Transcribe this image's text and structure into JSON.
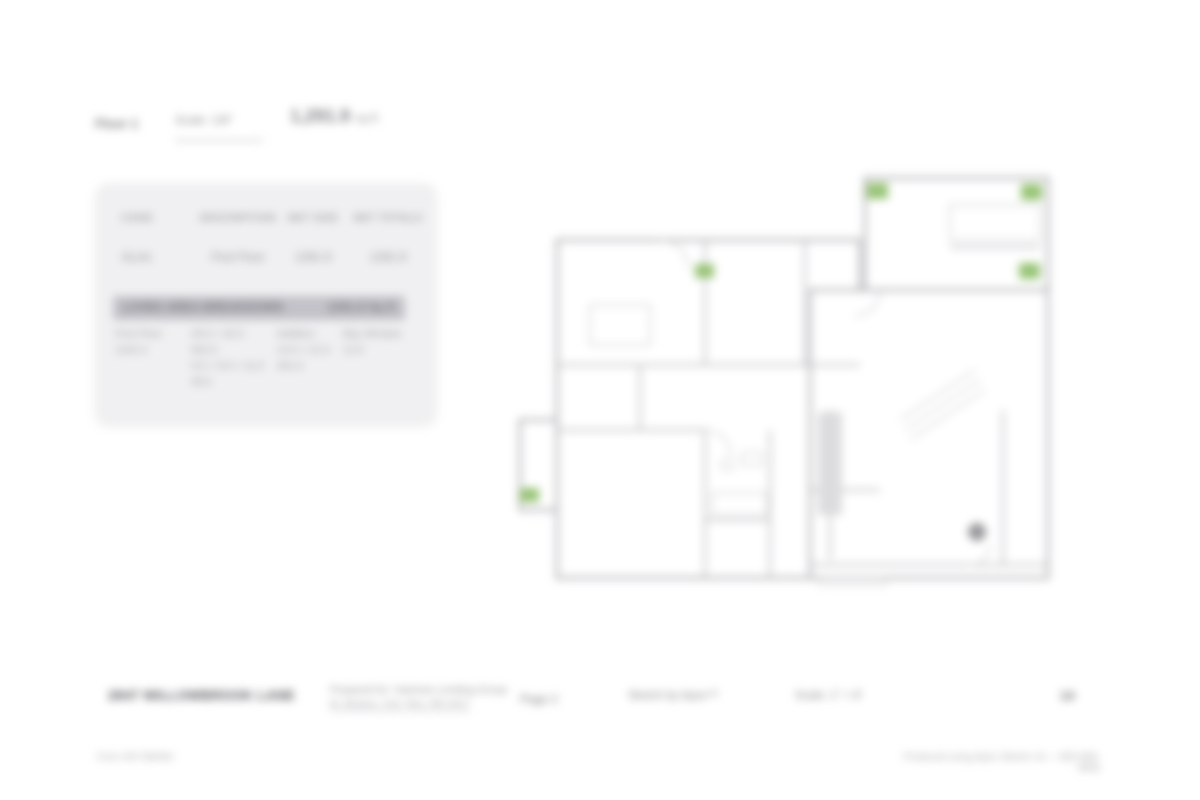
{
  "header": {
    "field1": "Floor 1",
    "field2": "Scale: 1/8\"",
    "area_value": "1,291.9",
    "area_unit": "sq ft"
  },
  "table": {
    "columns": [
      "CODE",
      "DESCRIPTION",
      "NET SIZE",
      "NET TOTALS"
    ],
    "row": [
      "GLA1",
      "First Floor",
      "1291.9",
      "1291.9"
    ],
    "band_left": "LIVING AREA BREAKDOWN",
    "band_right": "1291.9 Sq ft",
    "breakdown_cols": [
      {
        "lines": [
          "First Floor",
          "1242.4"
        ]
      },
      {
        "lines": [
          "29.0 × 32.5",
          "942.5",
          "0.5 × 9.0 × 11.0",
          "49.5"
        ]
      },
      {
        "lines": [
          "Addition",
          "14.0 × 21.5",
          "301.0"
        ]
      },
      {
        "lines": [
          "Bay Window",
          "12.6"
        ]
      }
    ]
  },
  "footer": {
    "address": "2847 WILLOWBROOK LANE",
    "prepared_label": "Prepared for: Hartman Lending Group",
    "prepared_value": "M. Alvarez, Cert. Res. RD-4417",
    "page_label": "Page 2",
    "sketch_credit": "Sketch by Apex™",
    "scale_note": "Scale: 1\" = 8'",
    "page_number": "14"
  },
  "subfooter": {
    "left": "Form SKT.BldSkI",
    "right": "Produced using Apex Sketch v6 — 800-858-9958"
  },
  "colors": {
    "accent_green": "#8fbf6a",
    "wall_gray": "#b2b2b6",
    "panel_bg": "#f0f0f2",
    "band_bg": "#c2c2c8",
    "page_bg": "#ffffff"
  }
}
